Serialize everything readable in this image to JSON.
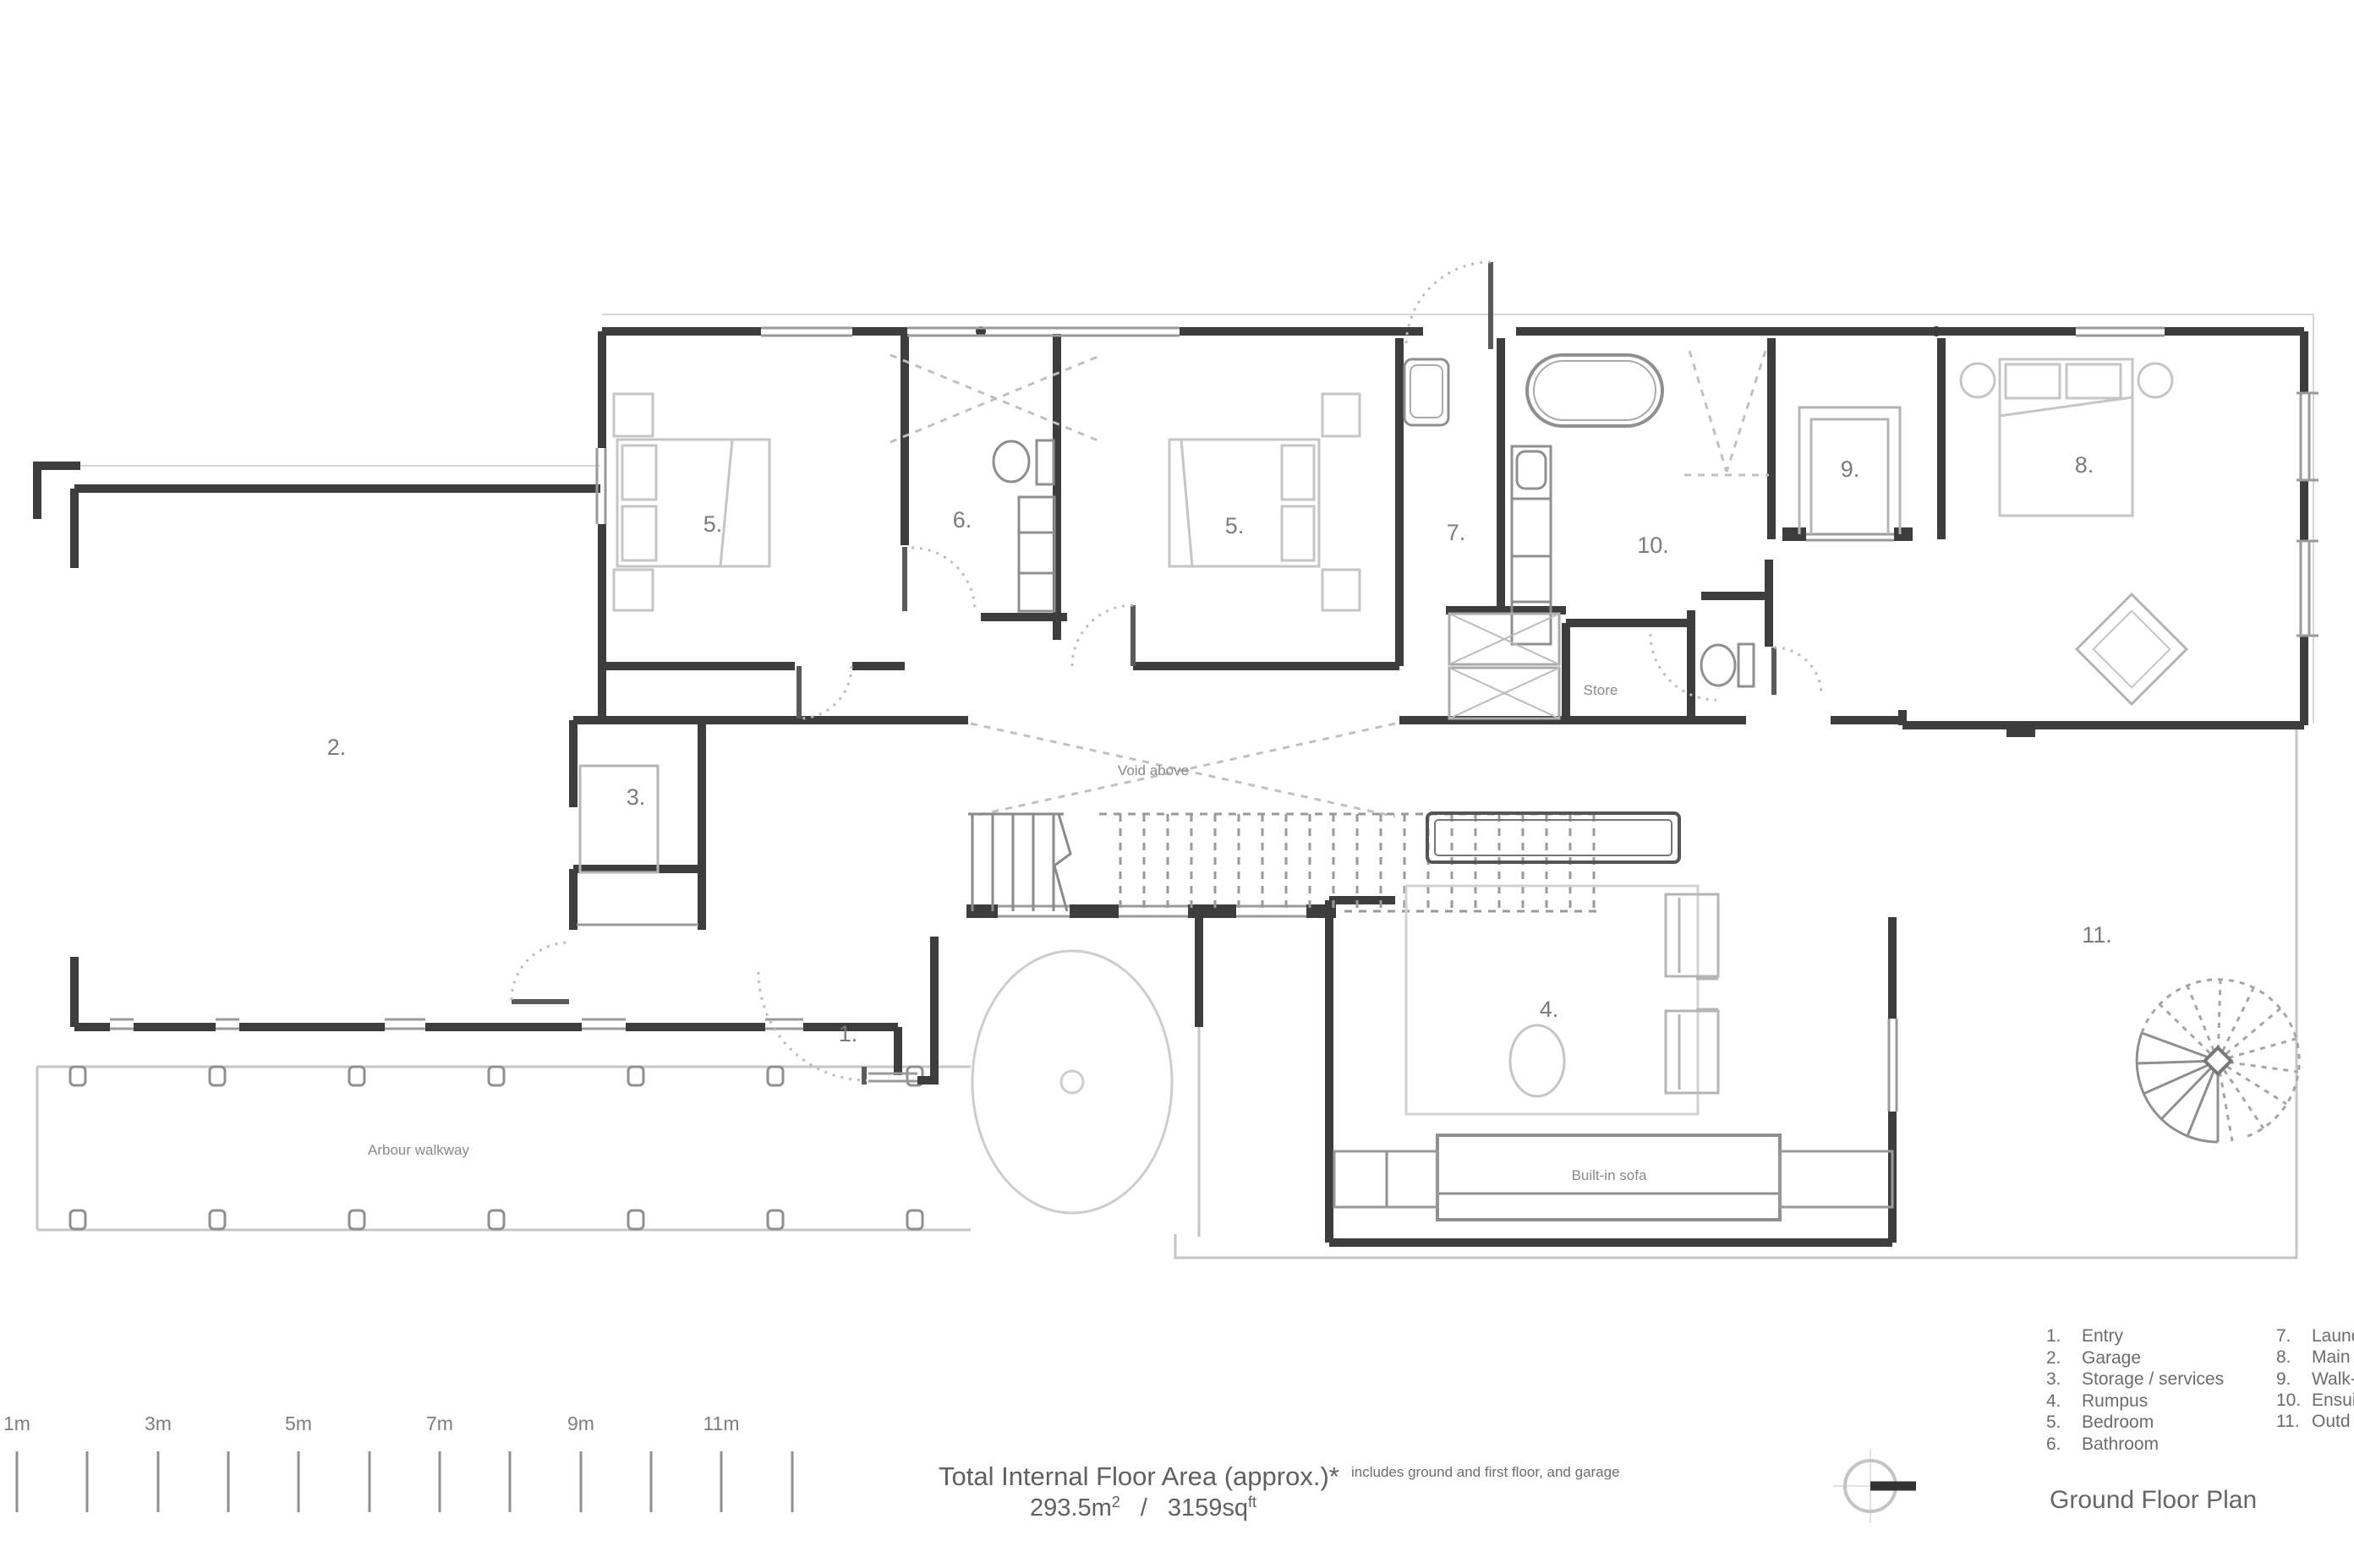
{
  "title": "Ground Floor Plan",
  "colors": {
    "wall": "#3d3d3d",
    "light_line": "#c6c6c6",
    "text": "#6c6c6c"
  },
  "plan": {
    "room_numbers": {
      "entry": "1.",
      "garage": "2.",
      "storage": "3.",
      "rumpus": "4.",
      "bedroom_a": "5.",
      "bathroom": "6.",
      "bedroom_b": "5.",
      "laundry": "7.",
      "main_bedroom": "8.",
      "walk_in_robe": "9.",
      "ensuite": "10.",
      "outdoor": "11."
    },
    "annotations": {
      "void_above": "Void above",
      "store": "Store",
      "built_in_sofa": "Built-in sofa",
      "arbour_walkway": "Arbour walkway"
    }
  },
  "scale_bar": {
    "labels": [
      "1m",
      "3m",
      "5m",
      "7m",
      "9m",
      "11m"
    ]
  },
  "footer": {
    "area_title": "Total Internal Floor Area (approx.)*",
    "area_note": "includes ground and first floor, and garage",
    "area_metric_value": "293.5m",
    "area_metric_sup": "2",
    "area_separator": "/",
    "area_imperial_value": "3159sq",
    "area_imperial_sup": "ft"
  },
  "legend": {
    "column1": [
      {
        "num": "1.",
        "label": "Entry"
      },
      {
        "num": "2.",
        "label": "Garage"
      },
      {
        "num": "3.",
        "label": "Storage / services"
      },
      {
        "num": "4.",
        "label": "Rumpus"
      },
      {
        "num": "5.",
        "label": "Bedroom"
      },
      {
        "num": "6.",
        "label": "Bathroom"
      }
    ],
    "column2": [
      {
        "num": "7.",
        "label": "Laund"
      },
      {
        "num": "8.",
        "label": "Main"
      },
      {
        "num": "9.",
        "label": "Walk-"
      },
      {
        "num": "10.",
        "label": "Ensui"
      },
      {
        "num": "11.",
        "label": "Outd"
      }
    ]
  }
}
